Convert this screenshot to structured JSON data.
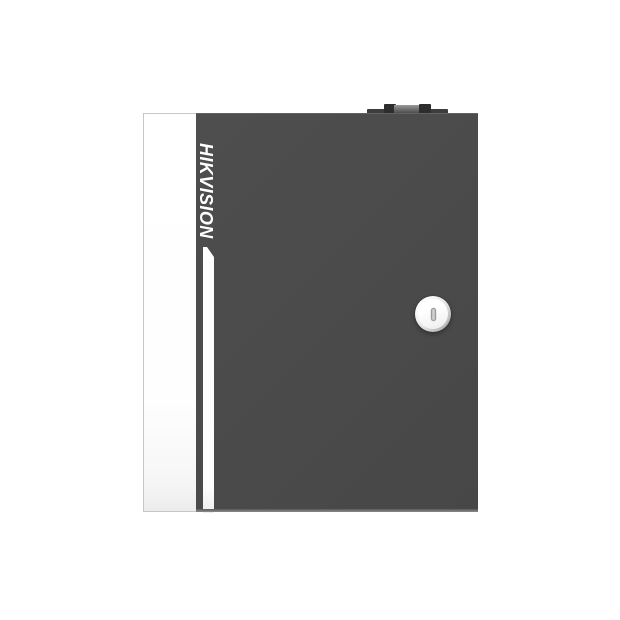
{
  "product": {
    "brand_label": "HIKVISION"
  },
  "icons": {
    "keyhole-icon": "vertical pill slot (css shape)",
    "top-hinge": "hinge knuckles with pin (css shapes)"
  },
  "colors": {
    "background": "#ffffff",
    "door": "#4b4b4b",
    "door_edge_highlight": "#626262",
    "door_bottom_lip": "#8a8a8a",
    "side_panel": "#ffffff",
    "side_panel_border": "#c7c7c7",
    "accent_stripe": "#fdfdfd",
    "brand_text": "#ffffff",
    "hinge_base": "#3d3d3d",
    "hinge_dark": "#2d2d2d",
    "hinge_pin": "#6f6f6f",
    "lock_ring": "#9b9b9b",
    "lock_face": "#f4f4f4",
    "keyhole": "#d2d2d2"
  }
}
